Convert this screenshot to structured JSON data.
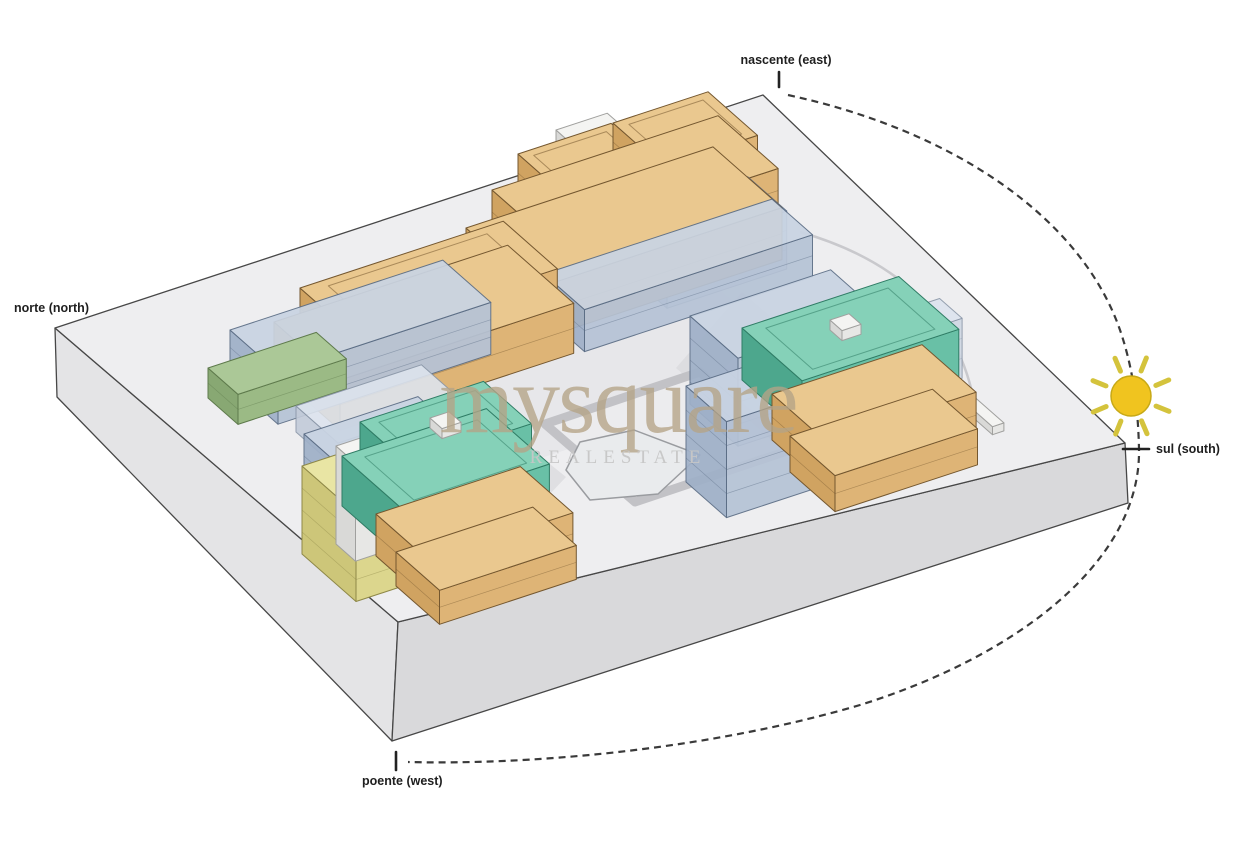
{
  "diagram_type": "architectural-site-sun-path-diagram",
  "labels": {
    "east": "nascente (east)",
    "north": "norte (north)",
    "south": "sul (south)",
    "west": "poente (west)"
  },
  "watermark": {
    "brand": "mysquare",
    "tagline": "REALESTATE"
  },
  "scene": {
    "colors": {
      "sun": "#f0c41f",
      "sun_stroke": "#c7a917",
      "ray": "#d4c33c",
      "path": "#3a3a3a"
    },
    "palettes": {
      "tan": {
        "top": "#eac88f",
        "sw": "#d0a361",
        "se": "#deb476",
        "stroke": "#74572f"
      },
      "teal": {
        "top": "#85d1b8",
        "sw": "#4da78d",
        "se": "#69c0a6",
        "stroke": "#2f7c65"
      },
      "blue": {
        "top": "#c9d4e3",
        "sw": "#9fb0c8",
        "se": "#b6c3d6",
        "stroke": "#5c6e86",
        "opacity": 0.93
      },
      "paleblue": {
        "top": "#dde4ee",
        "sw": "#c2cbd9",
        "se": "#cfd7e3",
        "stroke": "#8b97a8",
        "opacity": 0.9
      },
      "green": {
        "top": "#abc897",
        "sw": "#88a873",
        "se": "#9bba85",
        "stroke": "#5e7a4c"
      },
      "yellow": {
        "top": "#e9e5a4",
        "sw": "#cdc679",
        "se": "#dcd68d",
        "stroke": "#8e8848"
      },
      "white": {
        "top": "#f4f4f2",
        "sw": "#d9d9d7",
        "se": "#e7e7e5",
        "stroke": "#a0a09e"
      }
    },
    "boxes": [
      {
        "name": "north-roof-deck",
        "palette": "white",
        "x": 556,
        "y": 130,
        "w": 54,
        "d": 26,
        "h": 14,
        "floors": 1
      },
      {
        "name": "north-tan-upper-west",
        "palette": "tan",
        "x": 518,
        "y": 154,
        "w": 98,
        "d": 66,
        "h": 38,
        "floors": 2,
        "inset": true
      },
      {
        "name": "north-tan-upper-east",
        "palette": "tan",
        "x": 613,
        "y": 123,
        "w": 100,
        "d": 66,
        "h": 38,
        "floors": 2,
        "inset": true
      },
      {
        "name": "north-tan-mid",
        "palette": "tan",
        "x": 492,
        "y": 190,
        "w": 238,
        "d": 80,
        "h": 44,
        "floors": 2
      },
      {
        "name": "north-blue-east",
        "palette": "blue",
        "x": 628,
        "y": 216,
        "w": 126,
        "d": 52,
        "h": 58,
        "floors": 3
      },
      {
        "name": "north-tan-main",
        "palette": "tan",
        "x": 466,
        "y": 228,
        "w": 260,
        "d": 92,
        "h": 52,
        "floors": 2
      },
      {
        "name": "north-blue-front",
        "palette": "blue",
        "x": 544,
        "y": 274,
        "w": 240,
        "d": 54,
        "h": 42,
        "floors": 2
      },
      {
        "name": "north-blue-west",
        "palette": "blue",
        "x": 448,
        "y": 242,
        "w": 58,
        "d": 40,
        "h": 40,
        "floors": 2
      },
      {
        "name": "west-tan-upper",
        "palette": "tan",
        "x": 300,
        "y": 288,
        "w": 214,
        "d": 72,
        "h": 40,
        "floors": 2,
        "inset": true
      },
      {
        "name": "west-tan-main",
        "palette": "tan",
        "x": 274,
        "y": 322,
        "w": 246,
        "d": 88,
        "h": 50,
        "floors": 2
      },
      {
        "name": "west-blue",
        "palette": "blue",
        "x": 230,
        "y": 330,
        "w": 224,
        "d": 64,
        "h": 52,
        "floors": 3
      },
      {
        "name": "west-green-podium",
        "palette": "green",
        "x": 208,
        "y": 368,
        "w": 114,
        "d": 40,
        "h": 30,
        "floors": 2
      },
      {
        "name": "west-gray-link",
        "palette": "paleblue",
        "x": 296,
        "y": 406,
        "w": 132,
        "d": 56,
        "h": 26,
        "floors": 1
      },
      {
        "name": "sw-blue-low",
        "palette": "blue",
        "x": 304,
        "y": 434,
        "w": 120,
        "d": 66,
        "h": 44,
        "floors": 2
      },
      {
        "name": "sw-yellow",
        "palette": "yellow",
        "x": 302,
        "y": 466,
        "w": 58,
        "d": 72,
        "h": 88,
        "floors": 4
      },
      {
        "name": "sw-white-core",
        "palette": "white",
        "x": 336,
        "y": 446,
        "w": 28,
        "d": 26,
        "h": 98,
        "floors": 1
      },
      {
        "name": "sw-teal-upper",
        "palette": "teal",
        "x": 360,
        "y": 422,
        "w": 130,
        "d": 64,
        "h": 34,
        "floors": 1,
        "inset": true
      },
      {
        "name": "sw-teal-main",
        "palette": "teal",
        "x": 342,
        "y": 456,
        "w": 152,
        "d": 84,
        "h": 50,
        "floors": 1,
        "inset": true
      },
      {
        "name": "sw-teal-roofbox",
        "palette": "white",
        "x": 430,
        "y": 418,
        "w": 20,
        "d": 16,
        "h": 10,
        "floors": 1
      },
      {
        "name": "sw-orange-mid",
        "palette": "tan",
        "x": 376,
        "y": 514,
        "w": 152,
        "d": 70,
        "h": 42,
        "floors": 2
      },
      {
        "name": "sw-orange-low",
        "palette": "tan",
        "x": 396,
        "y": 552,
        "w": 144,
        "d": 58,
        "h": 34,
        "floors": 2
      },
      {
        "name": "east-blue-back",
        "palette": "blue",
        "x": 690,
        "y": 316,
        "w": 148,
        "d": 64,
        "h": 88,
        "floors": 4
      },
      {
        "name": "east-pale-slab",
        "palette": "paleblue",
        "x": 856,
        "y": 326,
        "w": 88,
        "d": 30,
        "h": 60,
        "floors": 3
      },
      {
        "name": "east-glass-wall",
        "palette": "white",
        "x": 844,
        "y": 296,
        "w": 12,
        "d": 198,
        "h": 8,
        "floors": 1
      },
      {
        "name": "east-blue-front",
        "palette": "blue",
        "x": 686,
        "y": 386,
        "w": 118,
        "d": 54,
        "h": 96,
        "floors": 4
      },
      {
        "name": "east-teal",
        "palette": "teal",
        "x": 742,
        "y": 328,
        "w": 165,
        "d": 80,
        "h": 52,
        "floors": 1,
        "inset": true
      },
      {
        "name": "east-teal-roofbox",
        "palette": "white",
        "x": 830,
        "y": 320,
        "w": 20,
        "d": 16,
        "h": 10,
        "floors": 1
      },
      {
        "name": "east-orange-mid",
        "palette": "tan",
        "x": 772,
        "y": 394,
        "w": 158,
        "d": 72,
        "h": 46,
        "floors": 2
      },
      {
        "name": "east-orange-low",
        "palette": "tan",
        "x": 790,
        "y": 436,
        "w": 150,
        "d": 60,
        "h": 36,
        "floors": 2
      }
    ]
  }
}
